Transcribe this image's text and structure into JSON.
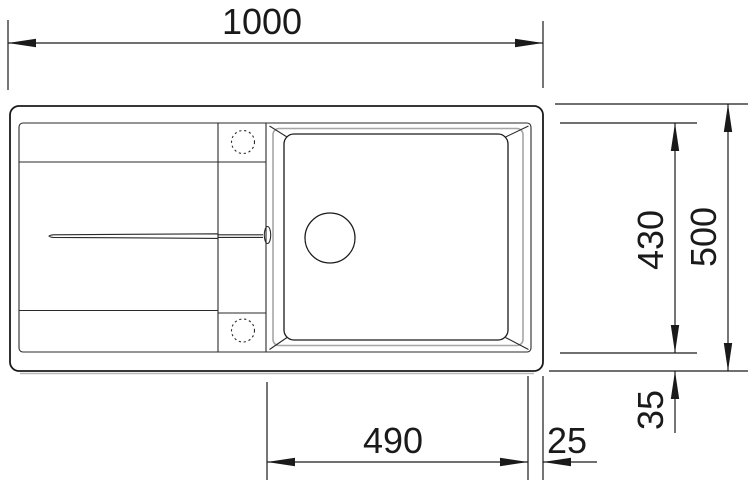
{
  "drawing": {
    "type": "technical-dimension-drawing",
    "subject": "kitchen sink top view with left drainboard and right bowl",
    "dimensions": {
      "overall_width": "1000",
      "overall_depth": "500",
      "inner_depth": "430",
      "bowl_width": "490",
      "bowl_edge_gap": "25",
      "rim_inset": "35"
    },
    "colors": {
      "line": "#1a1a1a",
      "shade": "#a6a6a6",
      "background": "#ffffff"
    }
  }
}
